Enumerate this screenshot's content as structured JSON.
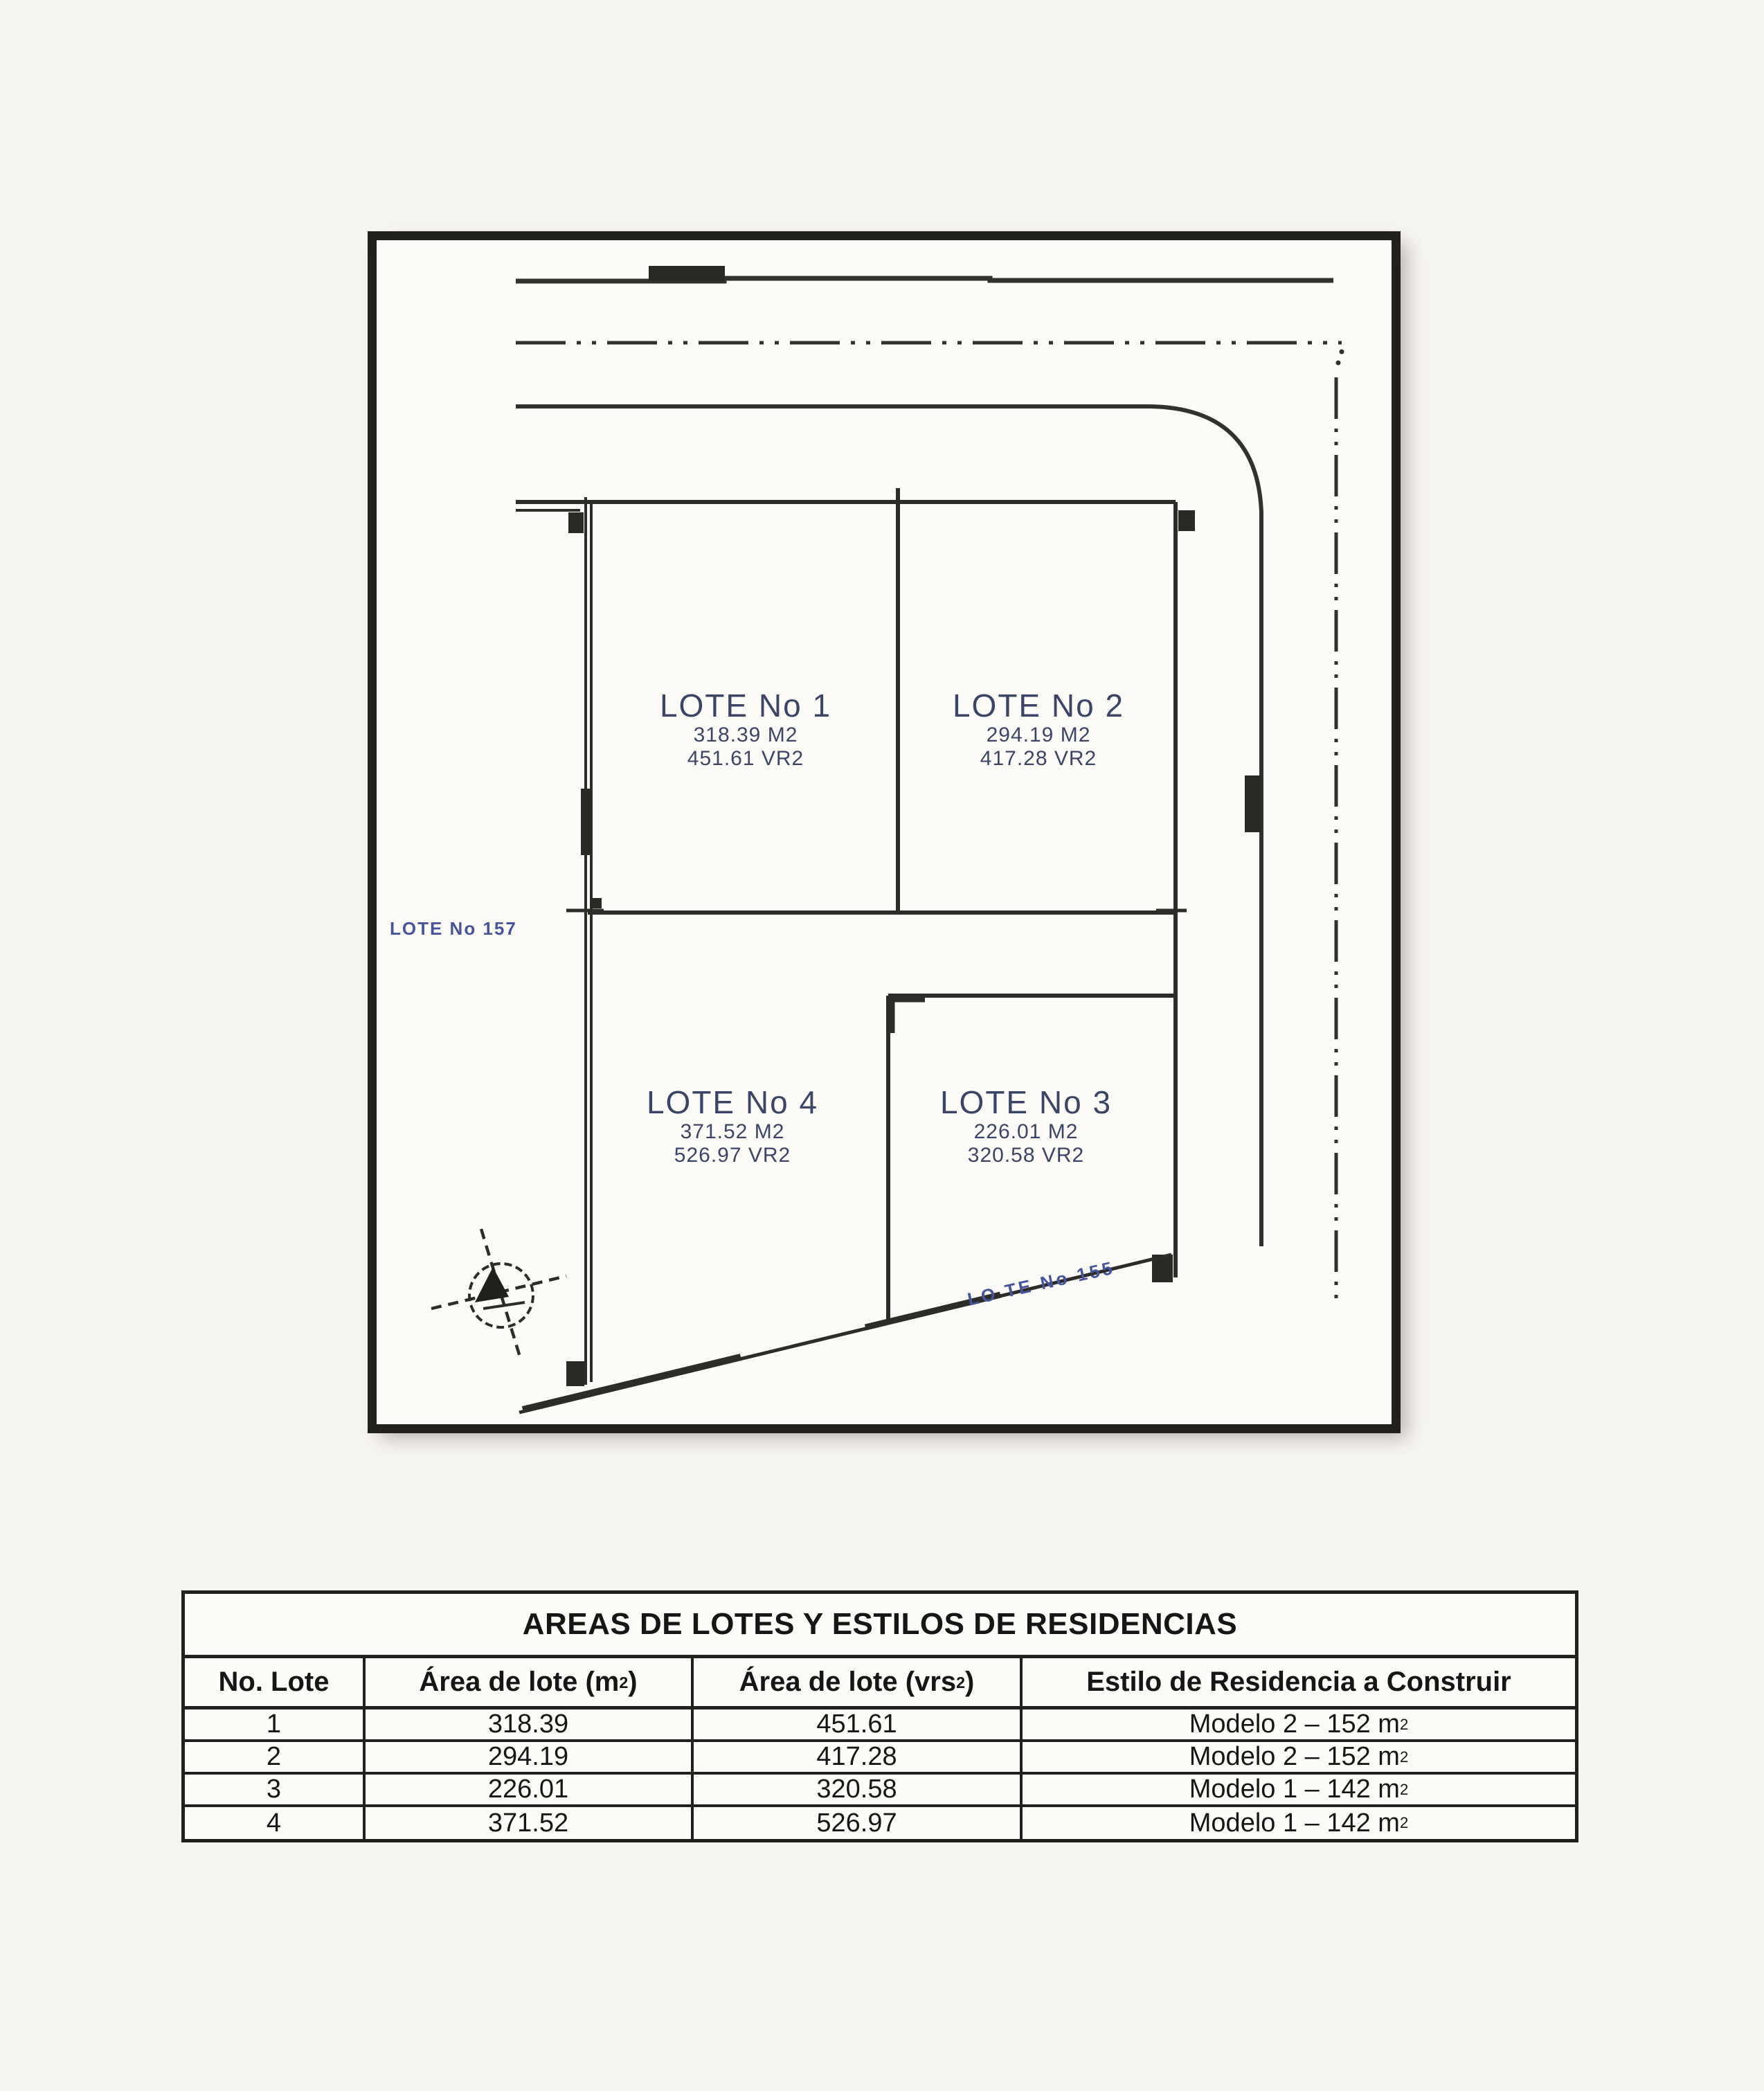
{
  "page": {
    "paper_color": "#f7f5f0",
    "ink_color": "#33312c",
    "label_ink_color": "#3d4566",
    "neighbor_ink_color": "#46549b"
  },
  "plan": {
    "lots": [
      {
        "name": "LOTE No 1",
        "area_m2": "318.39 M2",
        "area_vr2": "451.61 VR2"
      },
      {
        "name": "LOTE No 2",
        "area_m2": "294.19 M2",
        "area_vr2": "417.28 VR2"
      },
      {
        "name": "LOTE No 3",
        "area_m2": "226.01 M2",
        "area_vr2": "320.58 VR2"
      },
      {
        "name": "LOTE No 4",
        "area_m2": "371.52 M2",
        "area_vr2": "526.97 VR2"
      }
    ],
    "neighbor_left": "LOTE No 157",
    "neighbor_bottom": "LO TE No 155",
    "compass": "north-arrow-compass-rose"
  },
  "table": {
    "title": "AREAS DE LOTES Y ESTILOS DE RESIDENCIAS",
    "headers": {
      "col1": "No. Lote",
      "col2_pre": "Área de lote (m",
      "col2_sup": "2",
      "col2_post": ")",
      "col3_pre": "Área de lote (vrs",
      "col3_sup": "2",
      "col3_post": ")",
      "col4": "Estilo de Residencia a Construir"
    },
    "rows": [
      {
        "no": "1",
        "area_m2": "318.39",
        "area_vrs2": "451.61",
        "estilo": "Modelo 2 – 152 m",
        "estilo_sup": "2"
      },
      {
        "no": "2",
        "area_m2": "294.19",
        "area_vrs2": "417.28",
        "estilo": "Modelo 2 – 152 m",
        "estilo_sup": "2"
      },
      {
        "no": "3",
        "area_m2": "226.01",
        "area_vrs2": "320.58",
        "estilo": "Modelo 1 – 142 m",
        "estilo_sup": "2"
      },
      {
        "no": "4",
        "area_m2": "371.52",
        "area_vrs2": "526.97",
        "estilo": "Modelo 1 – 142 m",
        "estilo_sup": "2"
      }
    ]
  }
}
